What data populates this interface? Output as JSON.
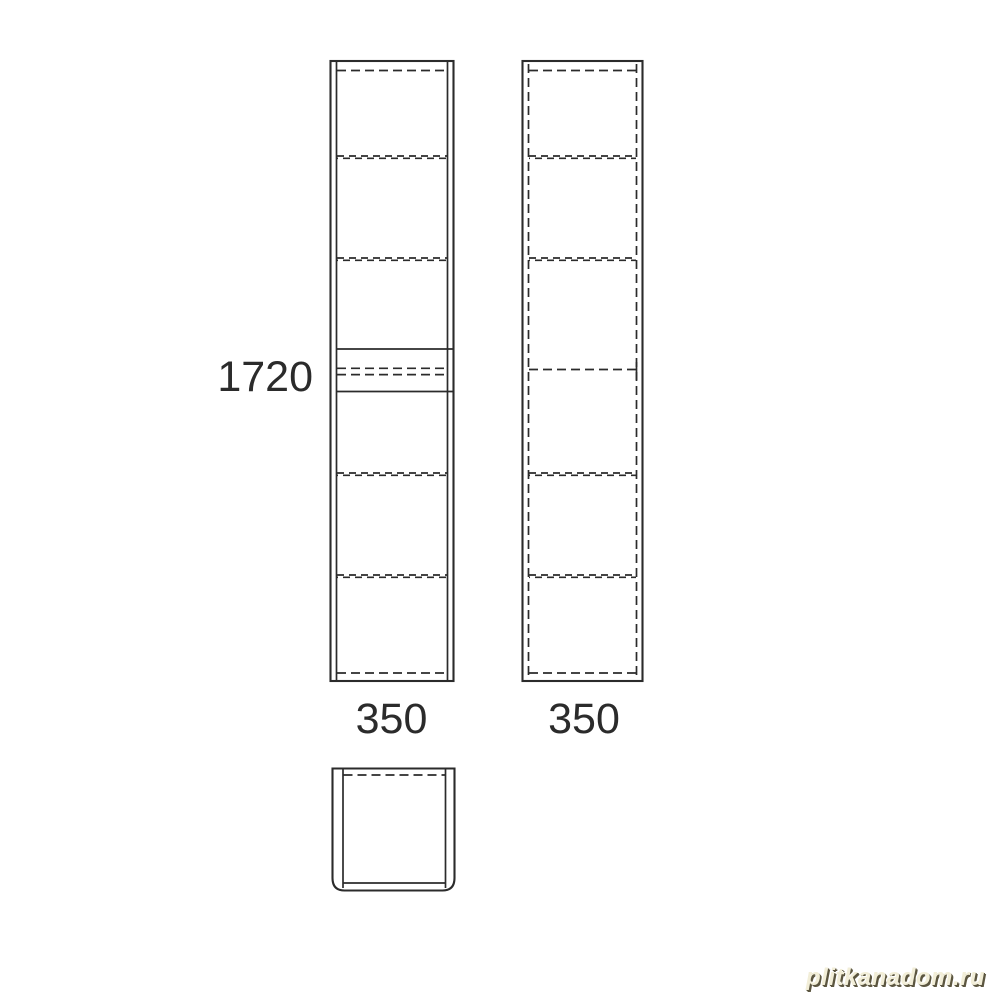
{
  "labels": {
    "height": "1720",
    "width_left": "350",
    "width_right": "350"
  },
  "watermark": {
    "text": "plitkanadom.ru"
  },
  "colors": {
    "line": "#2b2b2b",
    "background": "#ffffff",
    "watermark_fill": "#f2eed8",
    "watermark_shadow": "#5c5640"
  },
  "drawing": {
    "type": "furniture-technical-drawing",
    "views": 3,
    "shelf_lines_per_view": 4
  }
}
